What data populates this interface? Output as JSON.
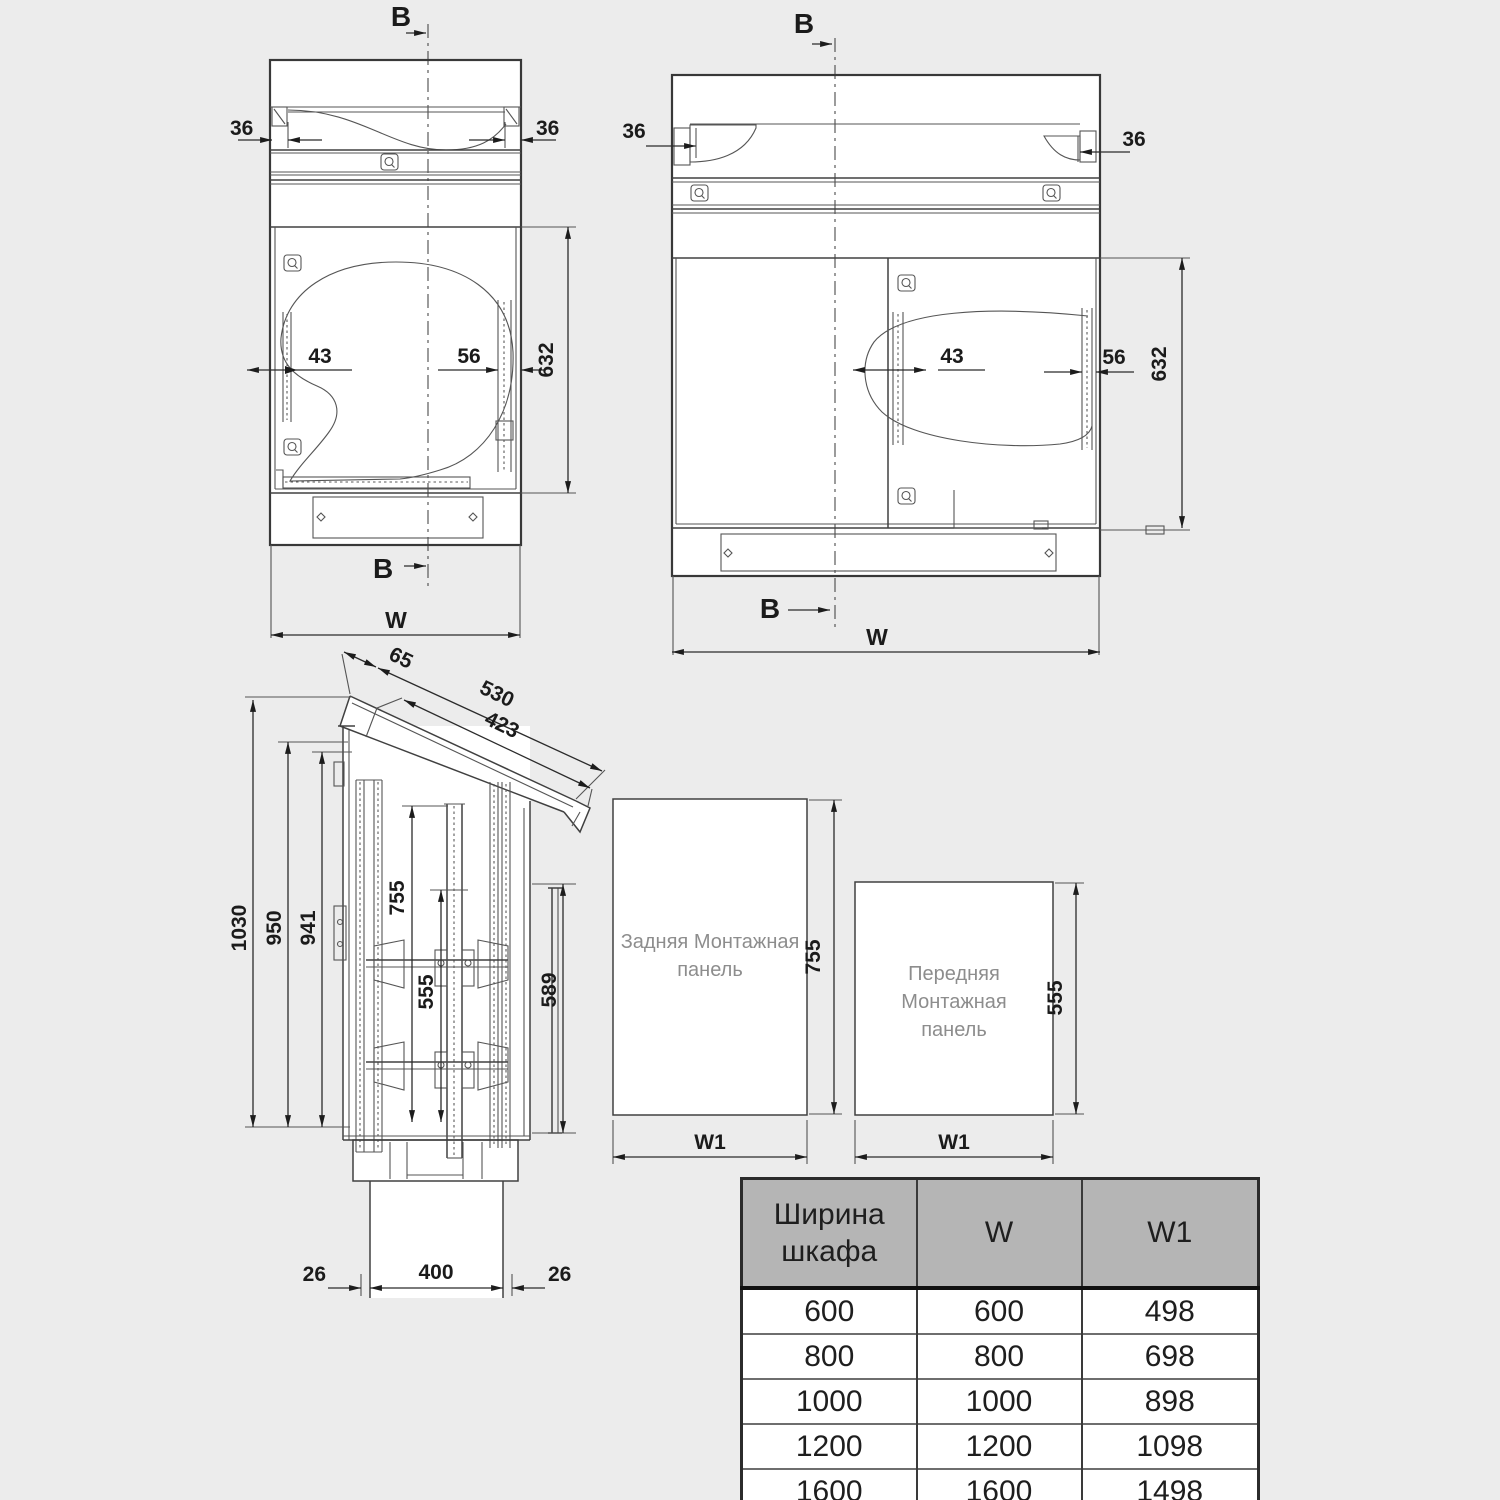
{
  "colors": {
    "background": "#ececec",
    "line": "#383838",
    "dim_text": "#1b1b1b",
    "panel_text": "#8d8d8d",
    "table_header_bg": "#b5b5b5",
    "table_border": "#2b2b2b",
    "drawing_fill": "#ffffff"
  },
  "views": {
    "back": {
      "section_label": "B",
      "dims": {
        "flange_left": "36",
        "flange_right": "36",
        "rail_left": "43",
        "rail_right": "56",
        "opening_height": "632",
        "width_label": "W"
      }
    },
    "front": {
      "section_label": "B",
      "dims": {
        "flange_left": "36",
        "flange_right": "36",
        "rail_left": "43",
        "rail_right": "56",
        "opening_height": "632",
        "width_label": "W"
      }
    },
    "side": {
      "dims": {
        "roof_cap": "65",
        "roof_outer": "530",
        "roof_inner": "423",
        "total_height": "1030",
        "body_height": "950",
        "rail_height": "941",
        "rear_panel": "755",
        "front_panel": "555",
        "side_panel": "589",
        "plinth_left": "26",
        "plinth_width": "400",
        "plinth_right": "26"
      }
    }
  },
  "panels": {
    "rear": {
      "label": "Задняя Монтажная панель",
      "height_label": "755",
      "width_label": "W1"
    },
    "front": {
      "label": "Передняя Монтажная панель",
      "height_label": "555",
      "width_label": "W1"
    }
  },
  "table": {
    "headers": [
      "Ширина шкафа",
      "W",
      "W1"
    ],
    "rows": [
      [
        "600",
        "600",
        "498"
      ],
      [
        "800",
        "800",
        "698"
      ],
      [
        "1000",
        "1000",
        "898"
      ],
      [
        "1200",
        "1200",
        "1098"
      ],
      [
        "1600",
        "1600",
        "1498"
      ]
    ]
  }
}
